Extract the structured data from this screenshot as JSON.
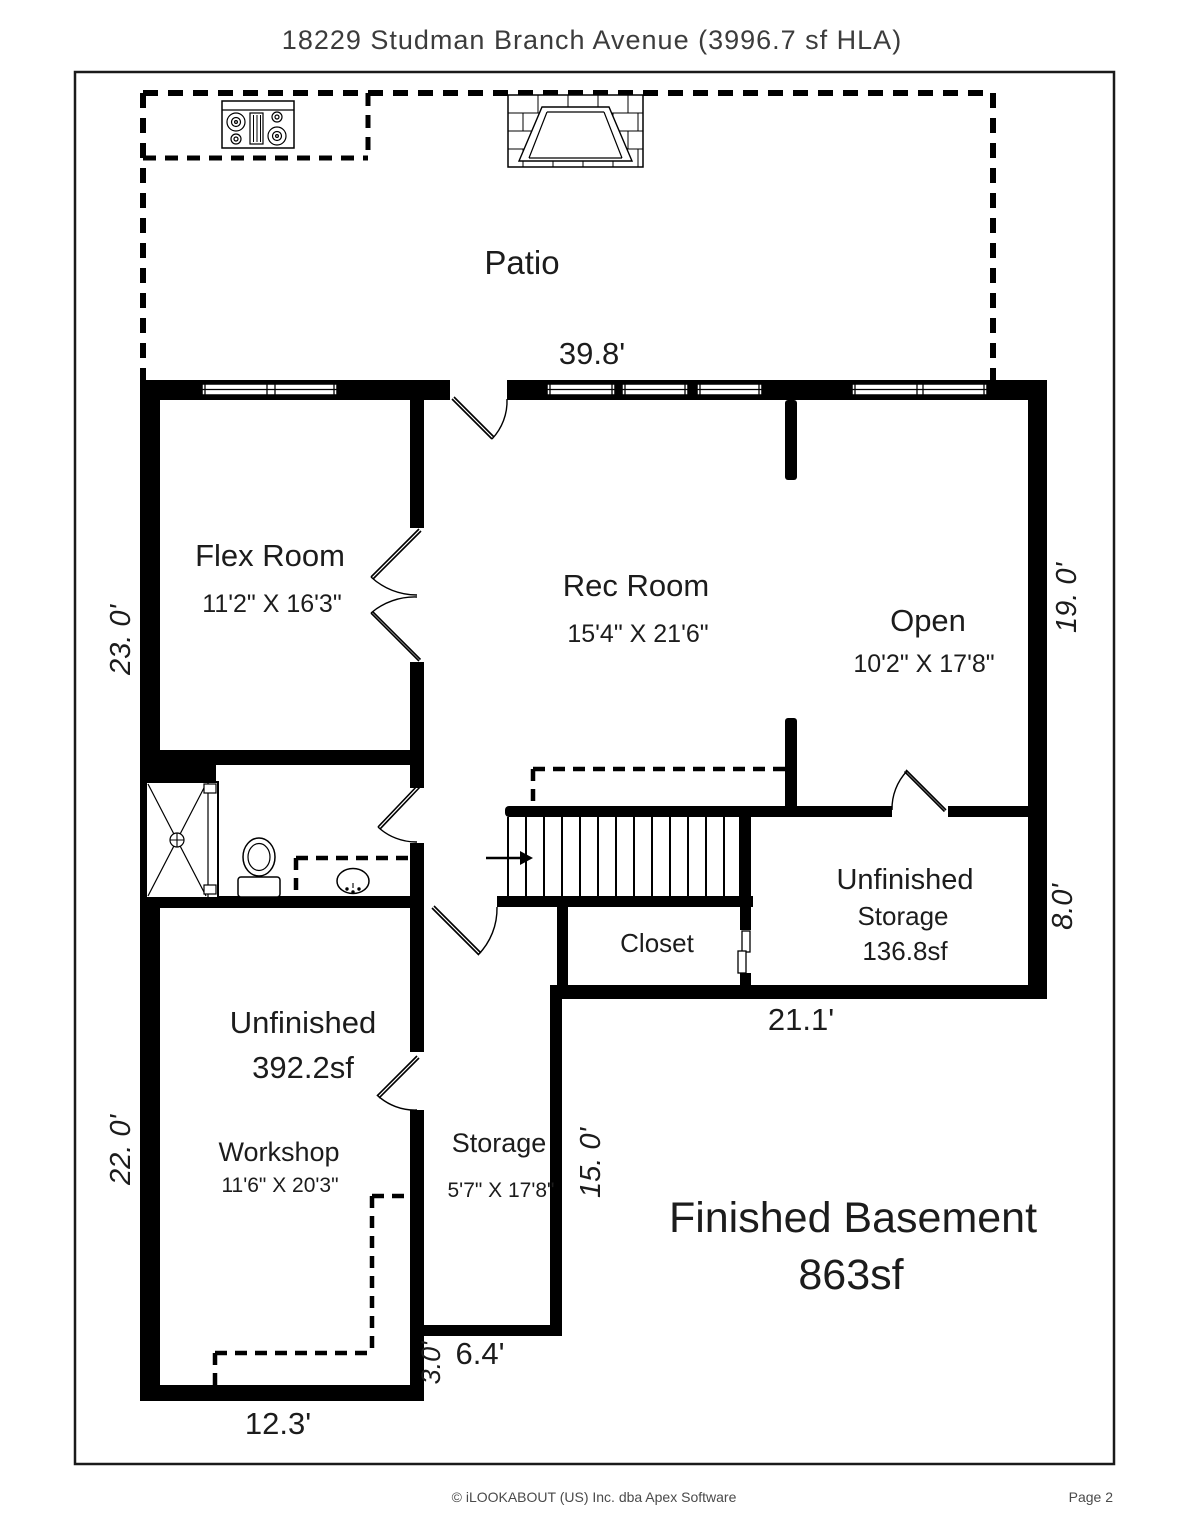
{
  "title": "18229 Studman Branch Avenue (3996.7 sf HLA)",
  "plan": {
    "patio_label": "Patio",
    "rooms": {
      "flex": {
        "name": "Flex Room",
        "dims": "11'2\" X 16'3\""
      },
      "rec": {
        "name": "Rec Room",
        "dims": "15'4\" X 21'6\""
      },
      "open": {
        "name": "Open",
        "dims": "10'2\" X 17'8\""
      },
      "unfinished_storage": {
        "line1": "Unfinished",
        "line2": "Storage",
        "line3": "136.8sf"
      },
      "closet": {
        "name": "Closet"
      },
      "unfinished": {
        "line1": "Unfinished",
        "line2": "392.2sf"
      },
      "workshop": {
        "name": "Workshop",
        "dims": "11'6\" X 20'3\""
      },
      "storage": {
        "name": "Storage",
        "dims": "5'7\" X 17'8\""
      },
      "finished_basement": {
        "line1": "Finished Basement",
        "line2": "863sf"
      }
    },
    "dimensions": {
      "top": "39.8'",
      "left_upper": "23. 0'",
      "left_lower": "22. 0'",
      "right_upper": "19. 0'",
      "right_lower": "8.0'",
      "bottom_right_section": "21.1'",
      "storage_height": "15. 0'",
      "notch": "3.0'",
      "storage_width": "6.4'",
      "bottom_left": "12.3'"
    }
  },
  "footer": {
    "copyright": "© iLOOKABOUT (US) Inc. dba Apex Software",
    "page": "Page 2"
  }
}
